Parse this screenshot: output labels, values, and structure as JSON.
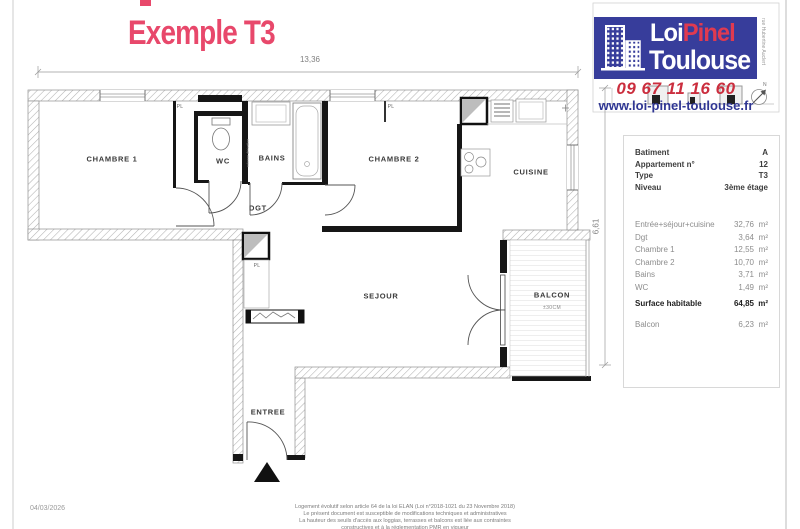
{
  "title": "Exemple T3",
  "dimensions": {
    "width_top": "13,36",
    "height_right": "6,61"
  },
  "plan": {
    "labels": {
      "chambre1": "CHAMBRE 1",
      "wc": "WC",
      "bains": "BAINS",
      "chambre2": "CHAMBRE 2",
      "cuisine": "CUISINE",
      "dgt": "DGT",
      "sejour": "SEJOUR",
      "balcon": "BALCON",
      "balcon_note": "±30CM",
      "entree": "ENTREE",
      "placard": "PL",
      "riser": "colonne dérivation"
    }
  },
  "logo": {
    "brand_word1": "Loi",
    "brand_word2": "Pinel",
    "brand_word3": "Toulouse",
    "phone": "09 67 11 16 60",
    "website": "www.loi-pinel-toulouse.fr",
    "street": "rue Hubertine Auclert",
    "compass_n": "N",
    "colors": {
      "logo_blue": "#373d9b",
      "logo_red": "#e03a50",
      "phone_red": "#cb2e3e",
      "web_blue": "#2f3693",
      "title_red": "#e8486b"
    }
  },
  "info_panel": {
    "details": [
      {
        "label": "Batiment",
        "value": "A"
      },
      {
        "label": "Appartement n°",
        "value": "12"
      },
      {
        "label": "Type",
        "value": "T3"
      },
      {
        "label": "Niveau",
        "value": "3ème étage"
      }
    ],
    "areas": [
      {
        "label": "Entrée+séjour+cuisine",
        "value": "32,76",
        "unit": "m²"
      },
      {
        "label": "Dgt",
        "value": "3,64",
        "unit": "m²"
      },
      {
        "label": "Chambre 1",
        "value": "12,55",
        "unit": "m²"
      },
      {
        "label": "Chambre 2",
        "value": "10,70",
        "unit": "m²"
      },
      {
        "label": "Bains",
        "value": "3,71",
        "unit": "m²"
      },
      {
        "label": "WC",
        "value": "1,49",
        "unit": "m²"
      }
    ],
    "total": {
      "label": "Surface habitable",
      "value": "64,85",
      "unit": "m²"
    },
    "extra": {
      "label": "Balcon",
      "value": "6,23",
      "unit": "m²"
    }
  },
  "footer": {
    "date": "04/03/2026",
    "legal": [
      "Logement évolutif selon article 64 de la loi ELAN (Loi n°2018-1021 du 23 Novembre 2018)",
      "Le présent document est susceptible de modifications techniques et administratives",
      "La hauteur des seuils d'accès aux loggias, terrasses et balcons est liée aux contraintes",
      "constructives et à la réglementation PMR en vigueur"
    ]
  }
}
